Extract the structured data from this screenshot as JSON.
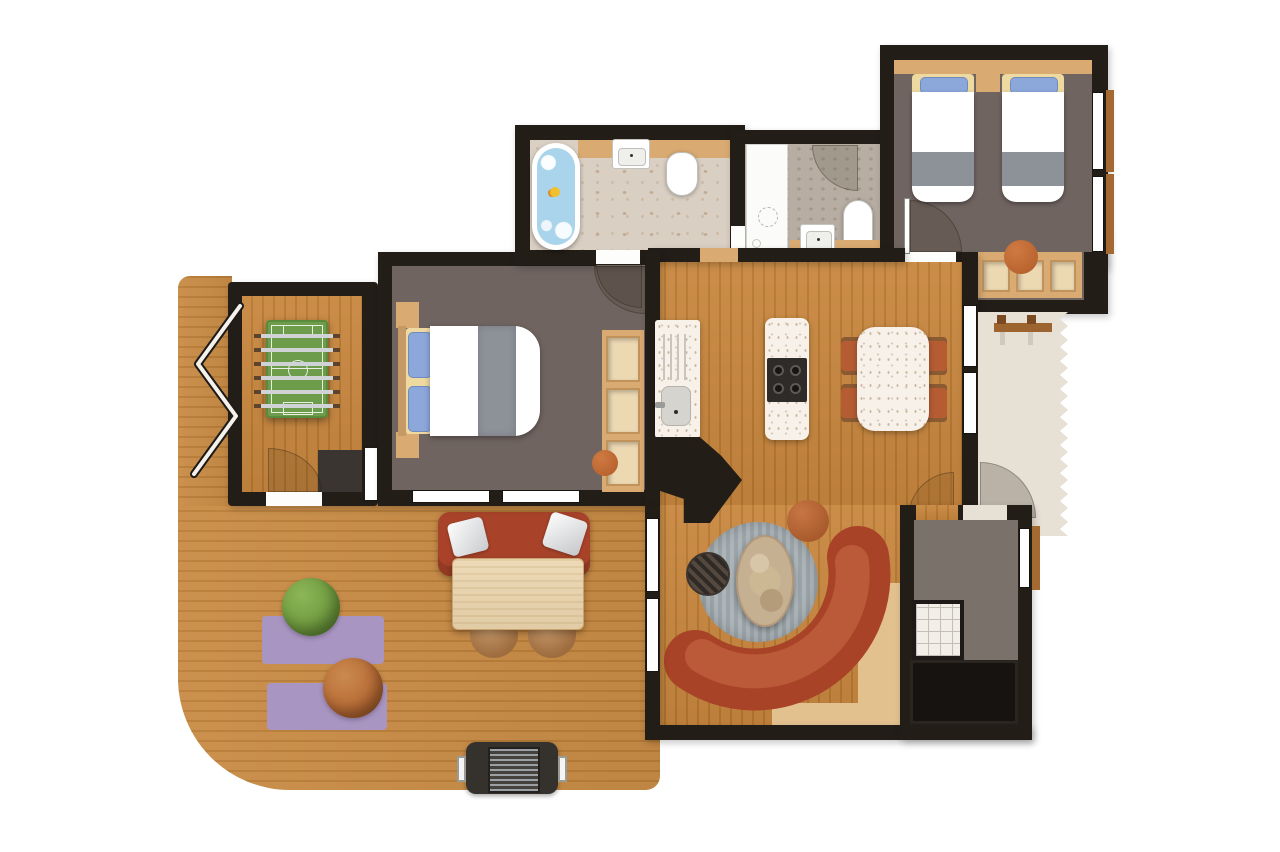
{
  "meta": {
    "kind": "floor-plan",
    "description": "Top-down holiday-lodge floor plan, no text labels visible"
  },
  "palette": {
    "wall": "#231d18",
    "wood_plank_light": "#c8873f",
    "wood_plank_dark": "#b5772f",
    "deck_plank_light": "#c98c46",
    "deck_plank_dark": "#b97d37",
    "bedroom_floor": "#6f6460",
    "hall_floor": "#7b716b",
    "marble": "#dacfc3",
    "stone": "#b7ada2",
    "terrace": "#e7e0d4",
    "terrazzo": "#f7f1ea",
    "tan": "#d9aa72",
    "tan_light": "#ecd9b2",
    "water": "#a9d4ec",
    "duck": "#f2c02e",
    "sofa": "#a84327",
    "sofa_cushion": "#bb5a38",
    "bench_sofa": "#a8432a",
    "chair": "#b65c33",
    "table_wood": "#ead4ac",
    "stone_table": "#c6b092",
    "rug_purple": "#a995c2",
    "rug_gray_a": "#adb5b9",
    "rug_gray_b": "#9ba4a9",
    "beanbag_green": "#6f9b3f",
    "beanbag_orange": "#b96b35",
    "pouf_orange": "#c2693a",
    "pitch_green": "#6d9c4b",
    "cooktop": "#2e2b28",
    "storage_dark": "#161310"
  },
  "rooms": [
    {
      "id": "deck",
      "furniture": [
        "bench-sofa",
        "throw-pillows",
        "dining-table",
        "stools",
        "purple-rugs",
        "green-beanbag",
        "orange-beanbag",
        "barbecue-grill"
      ]
    },
    {
      "id": "games-room",
      "furniture": [
        "foosball-table",
        "storage-block",
        "folding-door"
      ]
    },
    {
      "id": "master-bedroom",
      "furniture": [
        "double-bed",
        "nightstands",
        "wardrobe",
        "orange-pouf"
      ]
    },
    {
      "id": "family-bathroom",
      "furniture": [
        "bathtub",
        "rubber-duck",
        "washbasin",
        "toilet"
      ]
    },
    {
      "id": "shower-room",
      "furniture": [
        "shower",
        "toilet",
        "washbasin"
      ]
    },
    {
      "id": "twin-bedroom",
      "furniture": [
        "twin-bed-left",
        "twin-bed-right",
        "nightstand",
        "storage-bench",
        "orange-cushion"
      ]
    },
    {
      "id": "kitchen-dining",
      "furniture": [
        "sink-counter",
        "cooktop-island",
        "dining-table",
        "chairs",
        "fireplace"
      ]
    },
    {
      "id": "living-room",
      "furniture": [
        "round-rug",
        "stone-coffee-table",
        "checkered-pouf",
        "orange-pouf",
        "curved-sofa"
      ]
    },
    {
      "id": "entrance-hall",
      "furniture": [
        "tile-mat",
        "storage-unit"
      ]
    },
    {
      "id": "side-terrace",
      "furniture": [
        "wall-bench"
      ]
    }
  ]
}
